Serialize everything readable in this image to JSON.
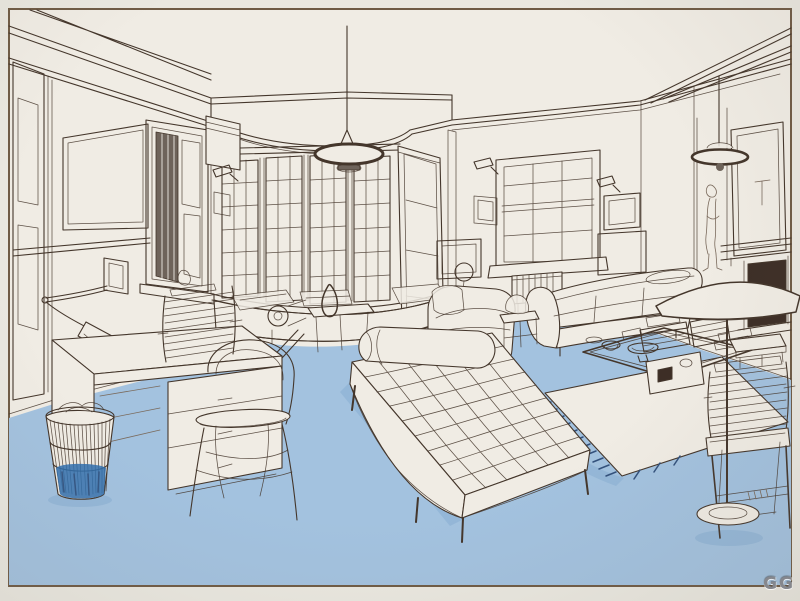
{
  "artwork": {
    "watermark": "GG",
    "alt": "Pen-and-ink interior perspective drawing of a studio living room with a light blue carpeted floor, bay window with window seat, tufted daybed, sofa, desk, bentwood chair, wire wastebasket, stacked books, pendant and floor lamps"
  },
  "colors": {
    "matte": "#eae8e0",
    "border_line": "#6f5b45",
    "paper": "#f0ece4",
    "ink": "#44362b",
    "ink_light": "#7a6a5c",
    "floor": "#a3c2df",
    "floor_shadow": "#88afd2",
    "accent_blue": "#2f6fae",
    "fringe_navy": "#33517c",
    "glass_dark": "#6e635a",
    "dark_opening": "#3d2e26",
    "watermark": "#85878d"
  },
  "scene": {
    "objects": [
      "ceiling-beams",
      "bay-window",
      "window-seat",
      "vase",
      "pendant-lamp",
      "saucer-pendant-lamp",
      "left-door",
      "wall-panel",
      "shuttered-window",
      "anglepoise-wall-lamp",
      "desk",
      "wire-wastebasket",
      "bentwood-chair",
      "book-stacks",
      "leaning-board",
      "scroll-bench",
      "tufted-daybed",
      "bolster",
      "armchair",
      "sofa",
      "radiator",
      "sash-window",
      "picture-frames",
      "wall-sconces",
      "figure-sketch",
      "mirror",
      "fireplace",
      "glass-coffee-table",
      "bowls",
      "floor-lamp",
      "stool-with-books",
      "white-fringed-rug",
      "blue-carpet"
    ]
  }
}
